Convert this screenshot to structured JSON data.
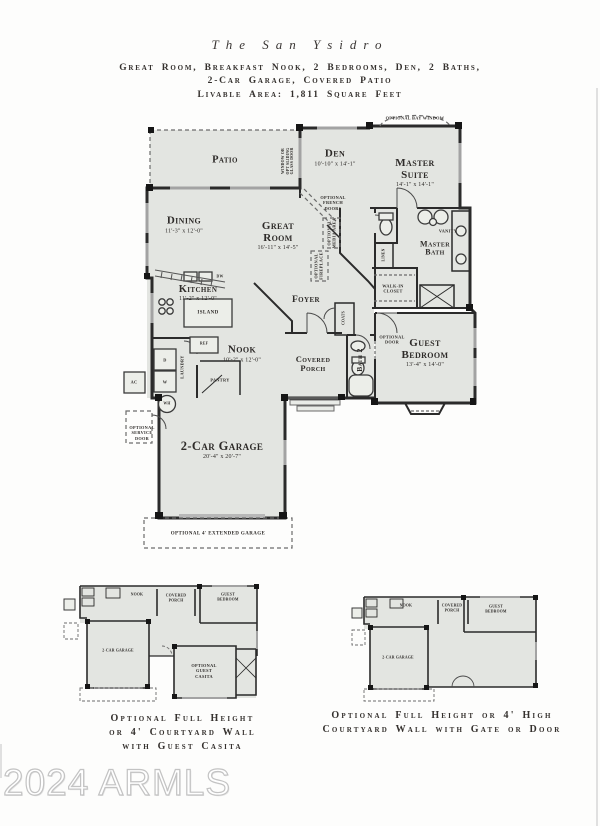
{
  "header": {
    "title": "The San Ysidro",
    "subtitle_line1": "Great Room, Breakfast Nook, 2 Bedrooms, Den, 2 Baths,",
    "subtitle_line2": "2-Car Garage, Covered Patio",
    "livable_area": "Livable Area: 1,811 Square Feet"
  },
  "colors": {
    "room_fill": "#e3e5e1",
    "wall": "#2b2b2b",
    "window": "#a3a3a3",
    "dashed": "#6b6b6b",
    "text": "#2f2d2b"
  },
  "main_plan": {
    "patio": {
      "name": "Patio"
    },
    "window_note": [
      "Window or",
      "Opt Sliding",
      "Glass Door"
    ],
    "den": {
      "name": "Den",
      "dims": "10'-10\" x 14'-1\""
    },
    "optional_bay_window": "Optional Bay Window",
    "master_suite": {
      "name": "Master Suite",
      "dims": "14'-1\" x 14'-1\""
    },
    "dining": {
      "name": "Dining",
      "dims": "11'-3\" x 12'-0\""
    },
    "great_room": {
      "name": "Great Room",
      "dims": "16'-11\" x 14'-5\""
    },
    "optional_french_doors": [
      "Optional",
      "French",
      "Doors"
    ],
    "optional_media_area": [
      "Optional",
      "Media Area"
    ],
    "optional_fireplace": [
      "Optional",
      "Fireplace"
    ],
    "linen": "Linen",
    "vanity": "Vanity",
    "master_bath": {
      "name": "Master Bath"
    },
    "walk_in_closet": {
      "name": "Walk-In Closet"
    },
    "kitchen": {
      "name": "Kitchen",
      "dims": "11'-2\" x 12'-0\""
    },
    "island": "Island",
    "dw": "DW",
    "foyer": {
      "name": "Foyer"
    },
    "nook": {
      "name": "Nook",
      "dims": "10'-2\" x 12'-0\""
    },
    "covered_porch": {
      "name": "Covered Porch"
    },
    "bath2": "Bath 2",
    "coats": "Coats",
    "optional_door": [
      "Optional",
      "Door"
    ],
    "guest_bedroom": {
      "name": "Guest Bedroom",
      "dims": "13'-4\" x 14'-0\""
    },
    "ref": "Ref",
    "pantry": "Pantry",
    "laundry": "Laundry",
    "dryer": "D",
    "washer": "W",
    "ac": "AC",
    "wh": "WH",
    "optional_service_door": [
      "Optional",
      "Service",
      "Door"
    ],
    "garage": {
      "name": "2-Car Garage",
      "dims": "20'-4\" x 20'-7\""
    },
    "optional_extended_garage": "Optional 4' Extended Garage"
  },
  "mini_left": {
    "labels": {
      "nook": "Nook",
      "covered_porch": [
        "Covered",
        "Porch"
      ],
      "guest_bedroom": [
        "Guest",
        "Bedroom"
      ],
      "garage": "2-Car Garage",
      "casita": [
        "Optional",
        "Guest",
        "Casita"
      ]
    },
    "caption": [
      "Optional Full Height",
      "or 4' Courtyard Wall",
      "with Guest Casita"
    ]
  },
  "mini_right": {
    "labels": {
      "nook": "Nook",
      "covered_porch": [
        "Covered",
        "Porch"
      ],
      "guest_bedroom": [
        "Guest",
        "Bedroom"
      ],
      "garage": "2-Car Garage"
    },
    "caption": [
      "Optional Full Height or 4' High",
      "Courtyard Wall with Gate or Door"
    ]
  },
  "watermark": "2024 ARMLS"
}
